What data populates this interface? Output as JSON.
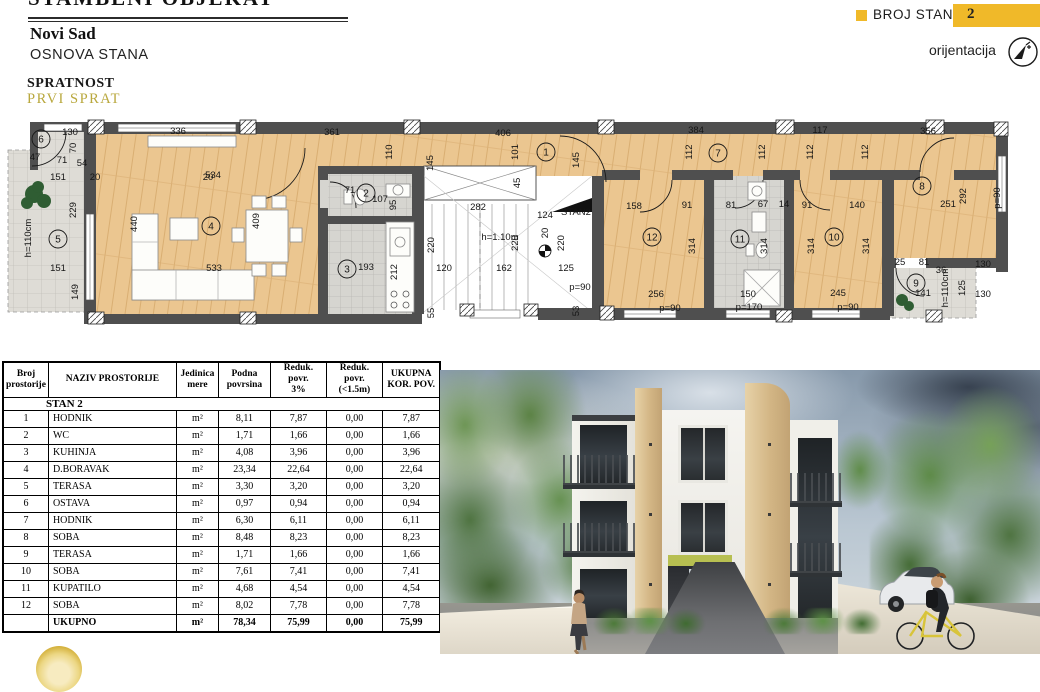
{
  "colors": {
    "accent_yellow": "#f0b929",
    "gold_text": "#b9a83e",
    "wall": "#4f4f4f",
    "wood": "#ebc690"
  },
  "header": {
    "clipped_title": "STAMBENI OBJEKAT",
    "city": "Novi Sad",
    "drawing_title": "OSNOVA STANA",
    "floor_label": "SPRATNOST",
    "floor_value": "PRVI SPRAT",
    "unit_badge_label": "BROJ STANA",
    "unit_badge_value": "2",
    "orientation_label": "orijentacija"
  },
  "plan": {
    "stan_arrow_label": "STAN2",
    "level_mark": "+3,01",
    "rooms": [
      {
        "n": "1",
        "x": 546,
        "y": 152
      },
      {
        "n": "2",
        "x": 366,
        "y": 193
      },
      {
        "n": "3",
        "x": 347,
        "y": 269
      },
      {
        "n": "4",
        "x": 211,
        "y": 226
      },
      {
        "n": "5",
        "x": 58,
        "y": 239
      },
      {
        "n": "6",
        "x": 41,
        "y": 139
      },
      {
        "n": "7",
        "x": 718,
        "y": 153
      },
      {
        "n": "8",
        "x": 922,
        "y": 186
      },
      {
        "n": "9",
        "x": 916,
        "y": 283
      },
      {
        "n": "10",
        "x": 834,
        "y": 237
      },
      {
        "n": "11",
        "x": 740,
        "y": 239
      },
      {
        "n": "12",
        "x": 652,
        "y": 237
      }
    ],
    "labels": [
      {
        "t": "130",
        "x": 70,
        "y": 135
      },
      {
        "t": "336",
        "x": 178,
        "y": 134
      },
      {
        "t": "361",
        "x": 332,
        "y": 135
      },
      {
        "t": "406",
        "x": 503,
        "y": 136
      },
      {
        "t": "384",
        "x": 696,
        "y": 133
      },
      {
        "t": "117",
        "x": 820,
        "y": 133
      },
      {
        "t": "356",
        "x": 928,
        "y": 134
      },
      {
        "t": "110",
        "x": 392,
        "y": 152,
        "r": 1
      },
      {
        "t": "145",
        "x": 433,
        "y": 163,
        "r": 1
      },
      {
        "t": "101",
        "x": 518,
        "y": 152,
        "r": 1
      },
      {
        "t": "145",
        "x": 579,
        "y": 160,
        "r": 1
      },
      {
        "t": "112",
        "x": 692,
        "y": 152,
        "r": 1
      },
      {
        "t": "112",
        "x": 765,
        "y": 152,
        "r": 1
      },
      {
        "t": "112",
        "x": 813,
        "y": 152,
        "r": 1
      },
      {
        "t": "112",
        "x": 868,
        "y": 152,
        "r": 1
      },
      {
        "t": "292",
        "x": 966,
        "y": 196,
        "r": 1
      },
      {
        "t": "p=90",
        "x": 1000,
        "y": 198,
        "r": 1
      },
      {
        "t": "70",
        "x": 76,
        "y": 148,
        "r": 1
      },
      {
        "t": "47",
        "x": 35,
        "y": 160
      },
      {
        "t": "71",
        "x": 62,
        "y": 163
      },
      {
        "t": "54",
        "x": 82,
        "y": 166
      },
      {
        "t": "151",
        "x": 58,
        "y": 180
      },
      {
        "t": "20",
        "x": 95,
        "y": 180
      },
      {
        "t": "534",
        "x": 213,
        "y": 178
      },
      {
        "t": "20",
        "x": 208,
        "y": 180
      },
      {
        "t": "71",
        "x": 350,
        "y": 193
      },
      {
        "t": "107",
        "x": 380,
        "y": 202
      },
      {
        "t": "95",
        "x": 396,
        "y": 205,
        "r": 1
      },
      {
        "t": "45",
        "x": 520,
        "y": 183,
        "r": 1
      },
      {
        "t": "282",
        "x": 478,
        "y": 210
      },
      {
        "t": "124",
        "x": 545,
        "y": 218
      },
      {
        "t": "158",
        "x": 634,
        "y": 209
      },
      {
        "t": "91",
        "x": 687,
        "y": 208
      },
      {
        "t": "81",
        "x": 731,
        "y": 208
      },
      {
        "t": "67",
        "x": 763,
        "y": 207
      },
      {
        "t": "14",
        "x": 784,
        "y": 207
      },
      {
        "t": "91",
        "x": 807,
        "y": 208
      },
      {
        "t": "140",
        "x": 857,
        "y": 208
      },
      {
        "t": "251",
        "x": 948,
        "y": 207
      },
      {
        "t": "229",
        "x": 76,
        "y": 210,
        "r": 1
      },
      {
        "t": "h=110cm",
        "x": 31,
        "y": 238,
        "r": 1
      },
      {
        "t": "440",
        "x": 137,
        "y": 224,
        "r": 1
      },
      {
        "t": "409",
        "x": 259,
        "y": 221,
        "r": 1
      },
      {
        "t": "220",
        "x": 434,
        "y": 245,
        "r": 1
      },
      {
        "t": "220",
        "x": 518,
        "y": 243,
        "r": 1
      },
      {
        "t": "220",
        "x": 564,
        "y": 243,
        "r": 1
      },
      {
        "t": "h=1.10m",
        "x": 500,
        "y": 240
      },
      {
        "t": "20",
        "x": 548,
        "y": 233,
        "r": 1
      },
      {
        "t": "314",
        "x": 695,
        "y": 246,
        "r": 1
      },
      {
        "t": "314",
        "x": 767,
        "y": 246,
        "r": 1
      },
      {
        "t": "314",
        "x": 814,
        "y": 246,
        "r": 1
      },
      {
        "t": "314",
        "x": 869,
        "y": 246,
        "r": 1
      },
      {
        "t": "212",
        "x": 397,
        "y": 272,
        "r": 1
      },
      {
        "t": "149",
        "x": 78,
        "y": 292,
        "r": 1
      },
      {
        "t": "151",
        "x": 58,
        "y": 271
      },
      {
        "t": "533",
        "x": 214,
        "y": 271
      },
      {
        "t": "193",
        "x": 366,
        "y": 270
      },
      {
        "t": "120",
        "x": 444,
        "y": 271
      },
      {
        "t": "162",
        "x": 504,
        "y": 271
      },
      {
        "t": "125",
        "x": 566,
        "y": 271
      },
      {
        "t": "256",
        "x": 656,
        "y": 297
      },
      {
        "t": "150",
        "x": 748,
        "y": 297
      },
      {
        "t": "245",
        "x": 838,
        "y": 296
      },
      {
        "t": "141",
        "x": 923,
        "y": 296
      },
      {
        "t": "25",
        "x": 900,
        "y": 265
      },
      {
        "t": "81",
        "x": 924,
        "y": 265
      },
      {
        "t": "36",
        "x": 941,
        "y": 273
      },
      {
        "t": "h=110cm",
        "x": 948,
        "y": 288,
        "r": 1
      },
      {
        "t": "125",
        "x": 965,
        "y": 288,
        "r": 1
      },
      {
        "t": "130",
        "x": 983,
        "y": 267
      },
      {
        "t": "130",
        "x": 983,
        "y": 297
      },
      {
        "t": "p=90",
        "x": 580,
        "y": 290
      },
      {
        "t": "p=90",
        "x": 670,
        "y": 311
      },
      {
        "t": "p=170",
        "x": 749,
        "y": 310
      },
      {
        "t": "p=90",
        "x": 848,
        "y": 310
      },
      {
        "t": "55",
        "x": 434,
        "y": 313,
        "r": 1
      },
      {
        "t": "53",
        "x": 579,
        "y": 311,
        "r": 1
      }
    ]
  },
  "table": {
    "headers": [
      "Broj\nprostorije",
      "NAZIV PROSTORIJE",
      "Jedinica\nmere",
      "Podna\npovrsina",
      "Reduk. povr.\n3%",
      "Reduk. povr.\n(<1.5m)",
      "UKUPNA\nKOR. POV."
    ],
    "section": "STAN 2",
    "unit": "m²",
    "rows": [
      {
        "no": "1",
        "name": "HODNIK",
        "podna": "8,11",
        "r3": "7,87",
        "r15": "0,00",
        "uk": "7,87"
      },
      {
        "no": "2",
        "name": "WC",
        "podna": "1,71",
        "r3": "1,66",
        "r15": "0,00",
        "uk": "1,66"
      },
      {
        "no": "3",
        "name": "KUHINJA",
        "podna": "4,08",
        "r3": "3,96",
        "r15": "0,00",
        "uk": "3,96"
      },
      {
        "no": "4",
        "name": "D.BORAVAK",
        "podna": "23,34",
        "r3": "22,64",
        "r15": "0,00",
        "uk": "22,64"
      },
      {
        "no": "5",
        "name": "TERASA",
        "podna": "3,30",
        "r3": "3,20",
        "r15": "0,00",
        "uk": "3,20"
      },
      {
        "no": "6",
        "name": "OSTAVA",
        "podna": "0,97",
        "r3": "0,94",
        "r15": "0,00",
        "uk": "0,94"
      },
      {
        "no": "7",
        "name": "HODNIK",
        "podna": "6,30",
        "r3": "6,11",
        "r15": "0,00",
        "uk": "6,11"
      },
      {
        "no": "8",
        "name": "SOBA",
        "podna": "8,48",
        "r3": "8,23",
        "r15": "0,00",
        "uk": "8,23"
      },
      {
        "no": "9",
        "name": "TERASA",
        "podna": "1,71",
        "r3": "1,66",
        "r15": "0,00",
        "uk": "1,66"
      },
      {
        "no": "10",
        "name": "SOBA",
        "podna": "7,61",
        "r3": "7,41",
        "r15": "0,00",
        "uk": "7,41"
      },
      {
        "no": "11",
        "name": "KUPATILO",
        "podna": "4,68",
        "r3": "4,54",
        "r15": "0,00",
        "uk": "4,54"
      },
      {
        "no": "12",
        "name": "SOBA",
        "podna": "8,02",
        "r3": "7,78",
        "r15": "0,00",
        "uk": "7,78"
      }
    ],
    "total": {
      "name": "UKUPNO",
      "podna": "78,34",
      "r3": "75,99",
      "r15": "0,00",
      "uk": "75,99"
    }
  }
}
